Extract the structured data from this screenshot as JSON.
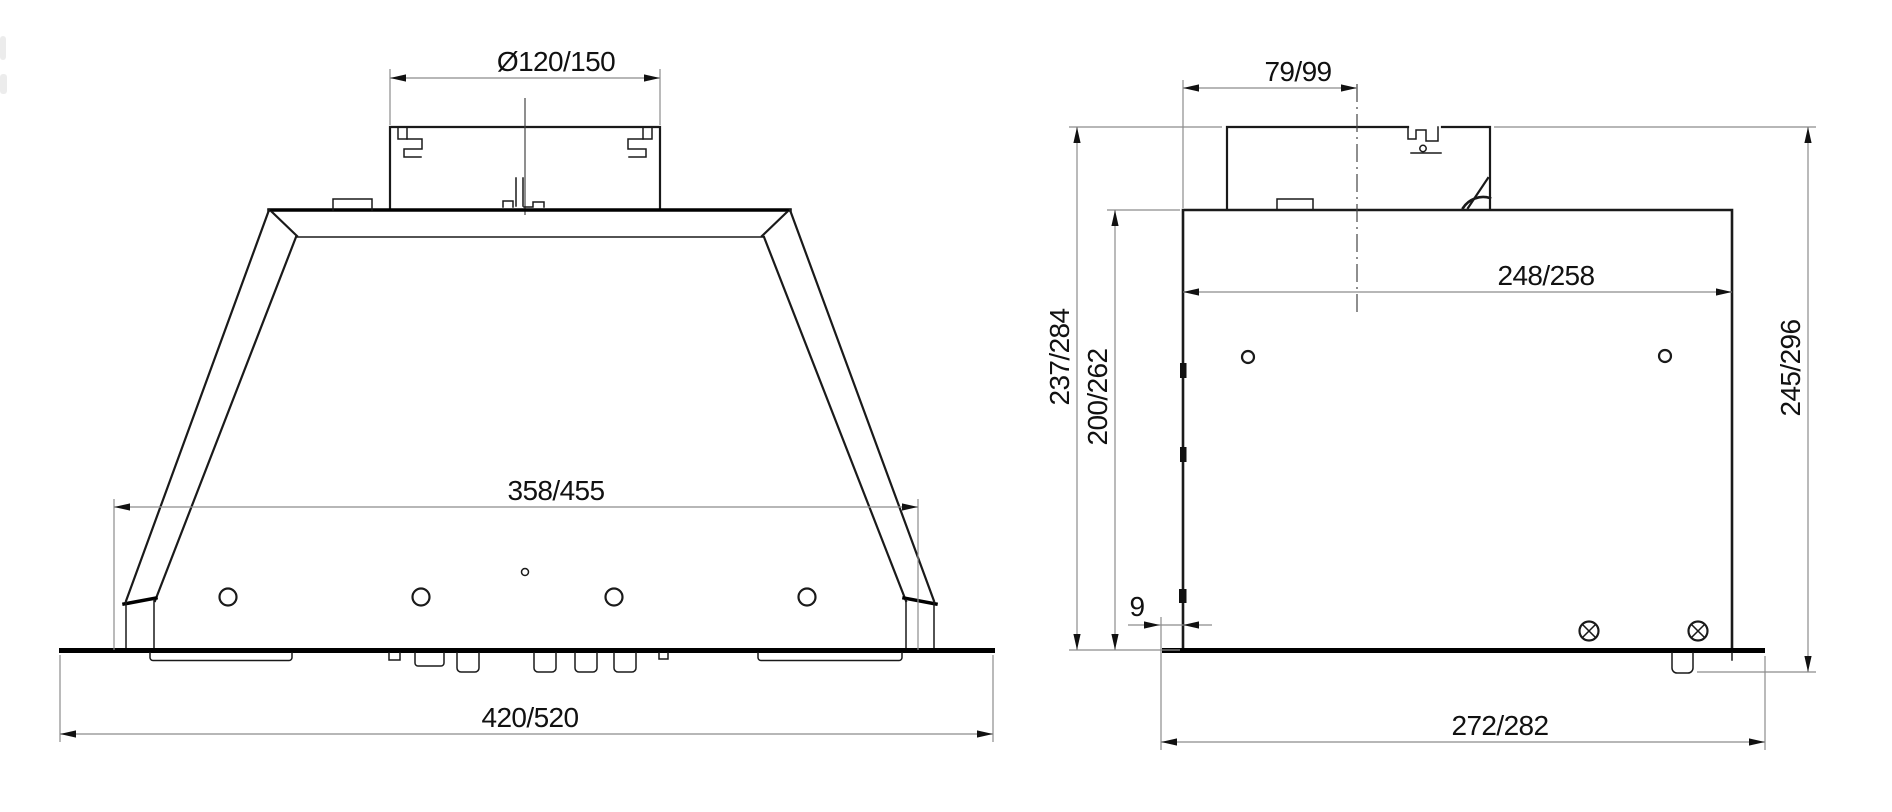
{
  "front_view": {
    "duct_diameter": "Ø120/150",
    "opening_width": "358/455",
    "overall_width": "420/520"
  },
  "side_view": {
    "duct_offset": "79/99",
    "box_width": "248/258",
    "height_with_duct": "237/284",
    "body_height": "200/262",
    "overall_height": "245/296",
    "plate_inset": "9",
    "plate_width": "272/282"
  },
  "colors": {
    "object_line": "#1a1a1a",
    "dimension_line": "#8c8c8c",
    "text": "#111111",
    "background": "#ffffff"
  }
}
